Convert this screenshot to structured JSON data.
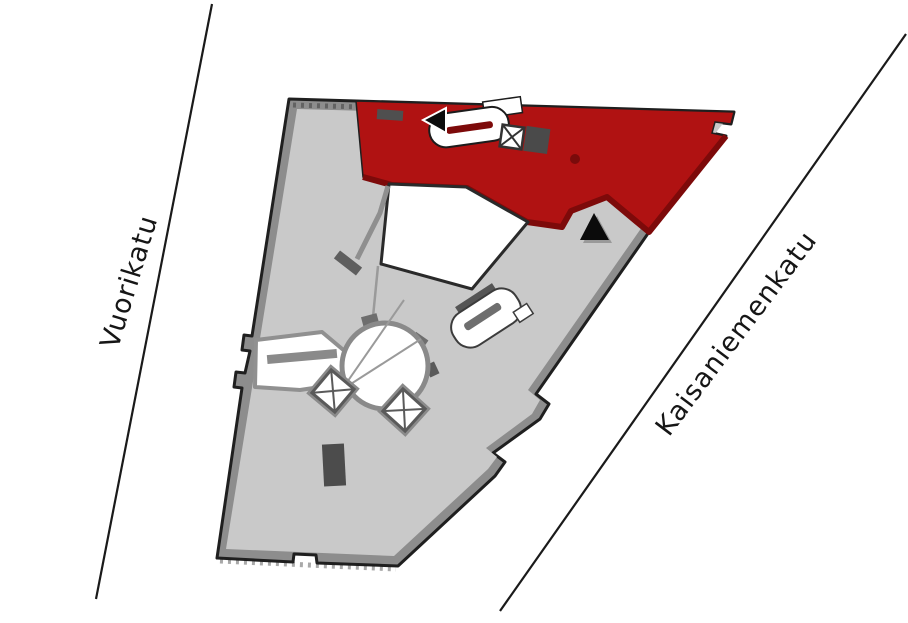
{
  "canvas": {
    "width": 908,
    "height": 623,
    "background": "#ffffff"
  },
  "streets": {
    "left": {
      "name": "Vuorikatu"
    },
    "right": {
      "name": "Kaisaniemenkatu"
    }
  },
  "floorplan": {
    "colors": {
      "highlight": "#b01212",
      "highlight_shadow": "#7d0a0a",
      "floor": "#c9c9c9",
      "wall": "#8d8d8d",
      "outline": "#1f1f1f",
      "detail_dark": "#4c4c4c",
      "room_white": "#ffffff"
    },
    "icons": {
      "elevator": "crossed-box",
      "staircase": "stadium-with-bar",
      "entrance_arrow": "black-triangle-left",
      "marker": "black-triangle-up"
    }
  }
}
